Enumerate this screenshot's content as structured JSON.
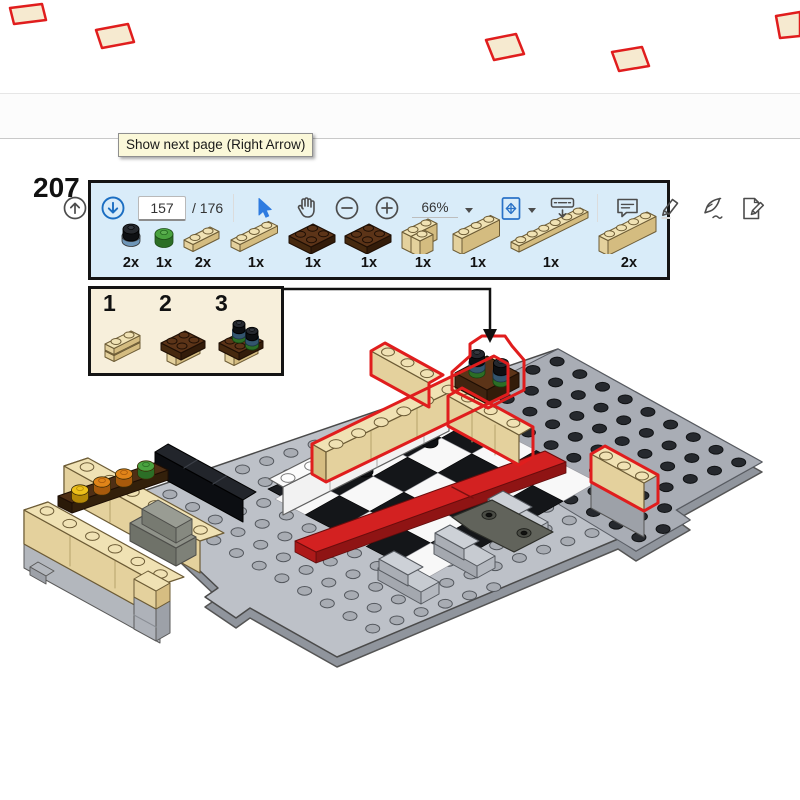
{
  "toolbar": {
    "tooltip": "Show next page (Right Arrow)",
    "page_current": "157",
    "page_total_label": "/ 176",
    "zoom_level": "66%",
    "icons": [
      "previous-page",
      "next-page",
      "select-tool",
      "hand-tool",
      "zoom-out",
      "zoom-in",
      "fit-page",
      "page-display",
      "comment",
      "highlight",
      "fill-sign",
      "edit-pdf"
    ]
  },
  "instruction": {
    "step_number": "207",
    "substep_labels": [
      "1",
      "2",
      "3"
    ],
    "parts": [
      {
        "qty": "2x",
        "name": "round-plate-1x1-black"
      },
      {
        "qty": "1x",
        "name": "round-plate-1x1-green"
      },
      {
        "qty": "2x",
        "name": "plate-1x2-tan"
      },
      {
        "qty": "1x",
        "name": "plate-1x3-tan"
      },
      {
        "qty": "1x",
        "name": "plate-2x2-brown"
      },
      {
        "qty": "1x",
        "name": "plate-2x2-brown"
      },
      {
        "qty": "1x",
        "name": "brick-corner-2x2-tan"
      },
      {
        "qty": "1x",
        "name": "brick-1x3-tan"
      },
      {
        "qty": "1x",
        "name": "plate-1x6-tan"
      },
      {
        "qty": "2x",
        "name": "brick-1x4-tan"
      }
    ]
  },
  "colors": {
    "highlight_red": "#e01d1d",
    "parts_box_bg": "#d9ecf9",
    "substeps_box_bg": "#f7efdb",
    "tooltip_bg": "#fbf8d9",
    "accent_blue": "#1b6ec2",
    "tan_top": "#f0e2b4",
    "brown_top": "#5c3418",
    "baseplate_gray": "#bdc1c8"
  }
}
